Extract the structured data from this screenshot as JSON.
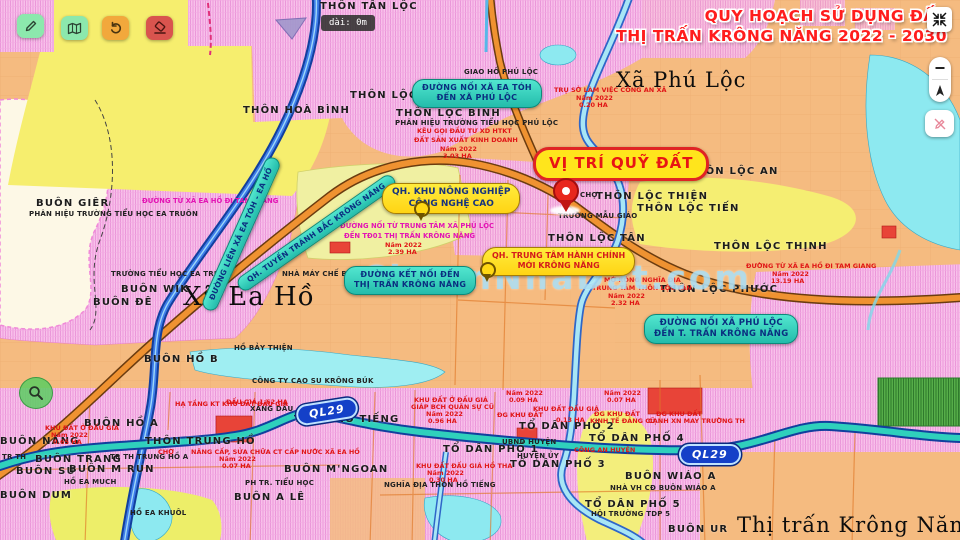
{
  "header": {
    "title_line1": "QUY HOẠCH SỬ DỤNG ĐẤT",
    "title_line2": "THỊ TRẤN KRÔNG NĂNG 2022 - 2030",
    "title_color": "#ff1d1d"
  },
  "toolbar": {
    "buttons": [
      {
        "id": "draw-button",
        "icon": "pencil-icon",
        "color": "#8ce8ad"
      },
      {
        "id": "legend-button",
        "icon": "map-book-icon",
        "color": "#8ce8ad"
      },
      {
        "id": "undo-button",
        "icon": "undo-icon",
        "color": "#f2a83c"
      },
      {
        "id": "erase-button",
        "icon": "eraser-icon",
        "color": "#d9544e"
      }
    ]
  },
  "tooltip": {
    "text": "dài: 0m"
  },
  "controls": {
    "compress": "compress-icon",
    "zoom_out": "minus-icon",
    "compass": "compass-icon",
    "no_draw": "pencil-slash-icon"
  },
  "roads": {
    "ql29": "QL29"
  },
  "watermark": {
    "text": "ChuanNhaDat.com"
  },
  "colors": {
    "teal_callout": "#2ec4b6",
    "yellow_callout": "#ffd916",
    "title_red": "#ff1d1d",
    "road_orange": "#ef9231",
    "road_blue": "#3e7ce8",
    "ql29_core": "#2fd0bc"
  },
  "callouts": {
    "vitri": "VỊ TRÍ QUỸ ĐẤT",
    "road_eatoh": [
      "ĐƯỜNG NỐI XÃ EA TÓH",
      "ĐẾN XÃ PHÚ LỘC"
    ],
    "bypass": "QH. TUYẾN TRÁNH BẮC KRÔNG NĂNG",
    "lienxa": "ĐƯỜNG LIÊN XÃ EA TÓH - EA HỒ",
    "ketnoi": [
      "ĐƯỜNG KẾT NỐI ĐẾN",
      "THỊ TRẤN KRÔNG NĂNG"
    ],
    "phuloc_noi": [
      "ĐƯỜNG NỐI XÃ PHÚ LỘC",
      "ĐẾN T. TRẤN KRÔNG NĂNG"
    ],
    "qh_nongnghiep": [
      "QH. KHU NÔNG NGHIỆP",
      "CÔNG NGHỆ CAO"
    ],
    "qh_hanhchinh": [
      "QH. TRUNG TÂM HÀNH CHÍNH",
      "MỚI KRÔNG NĂNG"
    ]
  },
  "map_labels": [
    {
      "t": "Xã Phú Lộc",
      "x": 616,
      "y": 70,
      "c": "town"
    },
    {
      "t": "Xã Ea Hồ",
      "x": 183,
      "y": 284,
      "c": "town town-lg"
    },
    {
      "t": "Thị trấn Krông Năng",
      "x": 737,
      "y": 515,
      "c": "town"
    },
    {
      "t": "THÔN TÂN LỘC",
      "x": 320,
      "y": 2,
      "c": "village"
    },
    {
      "t": "THÔN HOÀ BÌNH",
      "x": 243,
      "y": 106,
      "c": "village"
    },
    {
      "t": "THÔN LỘC",
      "x": 350,
      "y": 91,
      "c": "village"
    },
    {
      "t": "THÔN LỘC BÌNH",
      "x": 396,
      "y": 109,
      "c": "village"
    },
    {
      "t": "THÔN LỘC AN",
      "x": 688,
      "y": 167,
      "c": "village"
    },
    {
      "t": "THÔN LỘC THIỆN",
      "x": 596,
      "y": 192,
      "c": "village"
    },
    {
      "t": "THÔN LỘC TIẾN",
      "x": 637,
      "y": 204,
      "c": "village"
    },
    {
      "t": "THÔN LỘC THỊNH",
      "x": 714,
      "y": 242,
      "c": "village"
    },
    {
      "t": "THÔN LỘC PHƯỚC",
      "x": 660,
      "y": 285,
      "c": "village"
    },
    {
      "t": "THÔN LỘC TÂN",
      "x": 548,
      "y": 234,
      "c": "village"
    },
    {
      "t": "BUÔN GIÊR",
      "x": 36,
      "y": 199,
      "c": "village"
    },
    {
      "t": "BUÔN WIK",
      "x": 121,
      "y": 285,
      "c": "village"
    },
    {
      "t": "BUÔN ĐÊ",
      "x": 93,
      "y": 298,
      "c": "village"
    },
    {
      "t": "BUÔN HỒ B",
      "x": 144,
      "y": 355,
      "c": "village"
    },
    {
      "t": "BUÔN HỒ A",
      "x": 84,
      "y": 419,
      "c": "village"
    },
    {
      "t": "BUÔN NĂNG",
      "x": 0,
      "y": 437,
      "c": "village"
    },
    {
      "t": "BUÔN TRANG",
      "x": 35,
      "y": 455,
      "c": "village"
    },
    {
      "t": "BUÔN SÚ",
      "x": 16,
      "y": 467,
      "c": "village"
    },
    {
      "t": "BUÔN M RUN",
      "x": 69,
      "y": 465,
      "c": "village"
    },
    {
      "t": "BUÔN DUM",
      "x": 0,
      "y": 491,
      "c": "village"
    },
    {
      "t": "BUÔN A LÊ",
      "x": 234,
      "y": 493,
      "c": "village"
    },
    {
      "t": "BUÔN M'NGOAN",
      "x": 284,
      "y": 465,
      "c": "village"
    },
    {
      "t": "BUÔN UR",
      "x": 668,
      "y": 525,
      "c": "village"
    },
    {
      "t": "BUÔN WIÁO A",
      "x": 625,
      "y": 472,
      "c": "village"
    },
    {
      "t": "THÔN HỒ TIẾNG",
      "x": 294,
      "y": 415,
      "c": "village"
    },
    {
      "t": "THÔN TRUNG HỒ",
      "x": 145,
      "y": 437,
      "c": "village"
    },
    {
      "t": "TỔ DÂN PHỐ 1",
      "x": 443,
      "y": 445,
      "c": "village"
    },
    {
      "t": "TỔ DÂN PHỐ 2",
      "x": 519,
      "y": 422,
      "c": "village"
    },
    {
      "t": "TỔ DÂN PHỐ 3",
      "x": 510,
      "y": 460,
      "c": "village"
    },
    {
      "t": "TỔ DÂN PHỐ 4",
      "x": 589,
      "y": 434,
      "c": "village"
    },
    {
      "t": "TỔ DÂN PHỐ 5",
      "x": 585,
      "y": 500,
      "c": "village"
    },
    {
      "t": "GIAO HỒ PHÚ LỘC",
      "x": 464,
      "y": 69,
      "c": "small"
    },
    {
      "t": "PHÂN HIỆU TRƯỜNG TIỂU HỌC PHÚ LỘC",
      "x": 395,
      "y": 120,
      "c": "small"
    },
    {
      "t": "PHÂN HIỆU TRƯỜNG TIỂU HỌC EA TRUÔN",
      "x": 29,
      "y": 211,
      "c": "small"
    },
    {
      "t": "TRƯỜNG TIỂU HỌC EA TRUÔN",
      "x": 111,
      "y": 271,
      "c": "small"
    },
    {
      "t": "TRƯỜNG MẪU GIÁO",
      "x": 558,
      "y": 213,
      "c": "small"
    },
    {
      "t": "CHỢ",
      "x": 580,
      "y": 192,
      "c": "small"
    },
    {
      "t": "HỒ BẢY THIỆN",
      "x": 234,
      "y": 345,
      "c": "small"
    },
    {
      "t": "CÔNG TY CAO SU KRÔNG BÚK",
      "x": 252,
      "y": 378,
      "c": "small"
    },
    {
      "t": "NHÀ MÁY CHẾ BIẾN M",
      "x": 282,
      "y": 271,
      "c": "small"
    },
    {
      "t": "XĂNG DẦU",
      "x": 250,
      "y": 406,
      "c": "small"
    },
    {
      "t": "PH TR. TIỂU HỌC",
      "x": 245,
      "y": 480,
      "c": "small"
    },
    {
      "t": "HỒ EA MUCH",
      "x": 64,
      "y": 479,
      "c": "small"
    },
    {
      "t": "HỒ EA KHUÔL",
      "x": 130,
      "y": 510,
      "c": "small"
    },
    {
      "t": "TR TH TRUNG HỒ A",
      "x": 110,
      "y": 454,
      "c": "small"
    },
    {
      "t": "TR TH",
      "x": 2,
      "y": 454,
      "c": "small"
    },
    {
      "t": "NHÀ VH CĐ BUÔN WIÁO A",
      "x": 610,
      "y": 485,
      "c": "small"
    },
    {
      "t": "HỘI TRƯỜNG TDP 5",
      "x": 591,
      "y": 511,
      "c": "small"
    },
    {
      "t": "UBND HUYỆN",
      "x": 502,
      "y": 439,
      "c": "small"
    },
    {
      "t": "HUYỆN ỦY",
      "x": 517,
      "y": 453,
      "c": "small"
    },
    {
      "t": "NGHĨA ĐỊA THÔN HỒ TIẾNG",
      "x": 384,
      "y": 482,
      "c": "small"
    },
    {
      "t": "CÔNG AN HUYỆN",
      "x": 574,
      "y": 447,
      "c": "red"
    },
    {
      "t": "TRỤ SỞ LÀM VIỆC CÔNG AN XÃ",
      "x": 554,
      "y": 87,
      "c": "red"
    },
    {
      "t": "Năm 2022",
      "x": 576,
      "y": 95,
      "c": "red"
    },
    {
      "t": "0.20 HA",
      "x": 579,
      "y": 102,
      "c": "red"
    },
    {
      "t": "KÊU GỌI ĐẦU TƯ XD HTKT",
      "x": 417,
      "y": 128,
      "c": "red"
    },
    {
      "t": "ĐẤT SẢN XUẤT KINH DOANH",
      "x": 414,
      "y": 137,
      "c": "red"
    },
    {
      "t": "Năm 2022",
      "x": 440,
      "y": 146,
      "c": "red"
    },
    {
      "t": "3.03 HA",
      "x": 443,
      "y": 153,
      "c": "red"
    },
    {
      "t": "ĐƯỜNG NỐI TỪ TRUNG TÂM XÃ PHÚ LỘC",
      "x": 340,
      "y": 223,
      "c": "magenta"
    },
    {
      "t": "ĐẾN TĐ01 THỊ TRẤN KRÔNG NĂNG",
      "x": 344,
      "y": 233,
      "c": "magenta"
    },
    {
      "t": "Năm 2022",
      "x": 385,
      "y": 242,
      "c": "red"
    },
    {
      "t": "2.39 HA",
      "x": 388,
      "y": 249,
      "c": "red"
    },
    {
      "t": "MỞ RỘNG NGHĨA ĐỊA",
      "x": 604,
      "y": 277,
      "c": "red"
    },
    {
      "t": "TRUNG TÂM THÔN LỘC TÂN",
      "x": 592,
      "y": 285,
      "c": "red"
    },
    {
      "t": "Năm 2022",
      "x": 608,
      "y": 293,
      "c": "red"
    },
    {
      "t": "2.32 HA",
      "x": 611,
      "y": 300,
      "c": "red"
    },
    {
      "t": "ĐƯỜNG TỪ XÃ EA HỒ ĐI TAM GIANG",
      "x": 746,
      "y": 263,
      "c": "red"
    },
    {
      "t": "Năm 2022",
      "x": 772,
      "y": 271,
      "c": "red"
    },
    {
      "t": "13.19 HA",
      "x": 771,
      "y": 278,
      "c": "red"
    },
    {
      "t": "ĐƯỜNG TỪ XÃ EA HỒ ĐI TAM GIANG",
      "x": 142,
      "y": 198,
      "c": "magenta"
    },
    {
      "t": "HẠ TẦNG KT KHU ĐẤT ĐẤU GIÁ",
      "x": 175,
      "y": 401,
      "c": "red"
    },
    {
      "t": "KHU ĐẤT Ở ĐẤU GIÁ",
      "x": 45,
      "y": 425,
      "c": "red"
    },
    {
      "t": "Năm 2022",
      "x": 51,
      "y": 432,
      "c": "red"
    },
    {
      "t": "0.65 HA",
      "x": 53,
      "y": 439,
      "c": "red"
    },
    {
      "t": "ĐẤU GIÁ 1.62 HA",
      "x": 226,
      "y": 399,
      "c": "red"
    },
    {
      "t": "KHU ĐẤT Ở ĐẤU GIÁ",
      "x": 414,
      "y": 397,
      "c": "red"
    },
    {
      "t": "GIÁP BCH QUÂN SỰ CŨ",
      "x": 411,
      "y": 404,
      "c": "red"
    },
    {
      "t": "Năm 2022",
      "x": 426,
      "y": 411,
      "c": "red"
    },
    {
      "t": "0.96 HA",
      "x": 428,
      "y": 418,
      "c": "red"
    },
    {
      "t": "KHU ĐẤT ĐẤU GIÁ HỒ THA",
      "x": 416,
      "y": 463,
      "c": "red"
    },
    {
      "t": "Năm 2022",
      "x": 427,
      "y": 470,
      "c": "red"
    },
    {
      "t": "0.30 HA",
      "x": 429,
      "y": 477,
      "c": "red"
    },
    {
      "t": "NÂNG CẤP, SỬA CHỮA CT CẤP NƯỚC XÃ EA HỒ",
      "x": 191,
      "y": 449,
      "c": "red"
    },
    {
      "t": "Năm 2022",
      "x": 219,
      "y": 456,
      "c": "red"
    },
    {
      "t": "0.07 HA",
      "x": 222,
      "y": 463,
      "c": "red"
    },
    {
      "t": "CHỢ",
      "x": 158,
      "y": 449,
      "c": "red"
    },
    {
      "t": "KHU ĐẤT ĐẤU GIÁ",
      "x": 533,
      "y": 406,
      "c": "red"
    },
    {
      "t": "ĐG KHU ĐẤT",
      "x": 497,
      "y": 412,
      "c": "red"
    },
    {
      "t": "0.13 HA",
      "x": 556,
      "y": 417,
      "c": "red"
    },
    {
      "t": "ĐG KHU ĐẤT",
      "x": 594,
      "y": 411,
      "c": "red"
    },
    {
      "t": "KINH TẾ ĐẢNG CŨ",
      "x": 590,
      "y": 418,
      "c": "red"
    },
    {
      "t": "ĐG KHU ĐẤT",
      "x": 656,
      "y": 411,
      "c": "red"
    },
    {
      "t": "CẠNH XN MAY TRƯỜNG TH",
      "x": 648,
      "y": 418,
      "c": "red"
    },
    {
      "t": "Năm 2022",
      "x": 506,
      "y": 390,
      "c": "red"
    },
    {
      "t": "0.09 HA",
      "x": 509,
      "y": 397,
      "c": "red"
    },
    {
      "t": "Năm 2022",
      "x": 604,
      "y": 390,
      "c": "red"
    },
    {
      "t": "0.07 HA",
      "x": 607,
      "y": 397,
      "c": "red"
    }
  ]
}
